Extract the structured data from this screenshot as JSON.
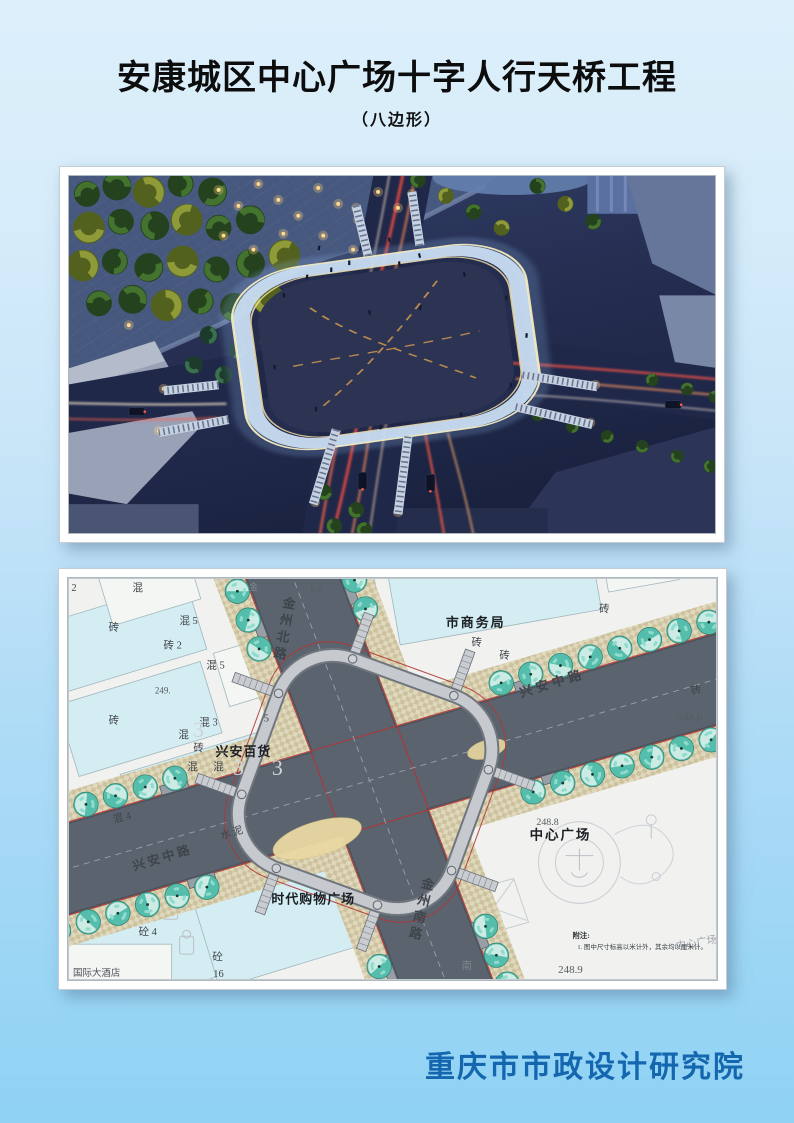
{
  "header": {
    "title": "安康城区中心广场十字人行天桥工程",
    "subtitle": "（八边形）"
  },
  "footer": {
    "organization": "重庆市市政设计研究院"
  },
  "colors": {
    "page_bg_top": "#dceffb",
    "page_bg_bottom": "#8fd2f4",
    "title_text": "#0d0d0d",
    "footer_text": "#1467ae",
    "map_road": "#5a636e",
    "map_sidewalk": "#d5cbaa",
    "map_building": "#d3edf3",
    "map_tree": "#55bdab",
    "map_red_line": "#b23636",
    "render_night_sky": "#222b4c",
    "render_ring_glow": "#cfe4f8"
  },
  "map": {
    "labels": [
      {
        "text": "金州北路",
        "x": 221,
        "y": 30,
        "size": 13,
        "w": 600,
        "vertical": true,
        "dy": 17,
        "rot": 10,
        "name": "label-jinzhou-north-road"
      },
      {
        "text": "金州南路",
        "x": 360,
        "y": 312,
        "size": 13,
        "w": 600,
        "vertical": true,
        "dy": 17,
        "rot": 14,
        "name": "label-jinzhou-south-road"
      },
      {
        "text": "兴安中路",
        "x": 487,
        "y": 110,
        "size": 13,
        "w": 600,
        "rot": -17,
        "ls": 4,
        "name": "label-xingan-middle-road-east"
      },
      {
        "text": "兴安中路",
        "x": 96,
        "y": 285,
        "size": 12.5,
        "w": 600,
        "rot": -17,
        "ls": 3,
        "name": "label-xingan-middle-road-west"
      },
      {
        "text": "市商务局",
        "x": 409,
        "y": 49,
        "size": 13,
        "w": 700,
        "ls": 2,
        "color": "#1b1f24",
        "name": "label-commerce-bureau"
      },
      {
        "text": "兴安百货",
        "x": 176,
        "y": 179,
        "size": 13,
        "w": 700,
        "ls": 1,
        "color": "#1b1f24",
        "name": "label-xingan-department-store"
      },
      {
        "text": "时代购物广场",
        "x": 246,
        "y": 327,
        "size": 13,
        "w": 700,
        "ls": 1,
        "color": "#1b1f24",
        "name": "label-times-shopping-plaza"
      },
      {
        "text": "中心广场",
        "x": 494,
        "y": 263,
        "size": 13.5,
        "w": 700,
        "ls": 2,
        "color": "#1b1f24",
        "name": "label-center-plaza"
      },
      {
        "text": "中心广场",
        "x": 631,
        "y": 370,
        "size": 10.5,
        "color": "#9aa2aa",
        "rot": -10,
        "name": "label-center-plaza-small"
      },
      {
        "text": "国际大酒店",
        "x": 5,
        "y": 400,
        "size": 9.5,
        "color": "#4a4f55",
        "anchor": "start",
        "name": "label-international-hotel"
      },
      {
        "text": "附注:",
        "x": 506,
        "y": 362,
        "size": 7.5,
        "w": 700,
        "anchor": "start",
        "color": "#2e3338",
        "name": "label-note-title"
      },
      {
        "text": "1. 图中尺寸标高以米计外，其余均以厘米计。",
        "x": 511,
        "y": 373,
        "size": 6.5,
        "anchor": "start",
        "color": "#3a4046",
        "name": "label-note-item"
      },
      {
        "text": "248.6",
        "x": 624,
        "y": 143,
        "size": 11,
        "color": "#565b62",
        "name": "label-elevation"
      },
      {
        "text": "248.8",
        "x": 481,
        "y": 248,
        "size": 10,
        "color": "#565b62",
        "name": "label-elevation"
      },
      {
        "text": "248.9",
        "x": 504,
        "y": 397,
        "size": 11,
        "color": "#565b62",
        "name": "label-elevation"
      },
      {
        "text": "249.",
        "x": 95,
        "y": 116,
        "size": 9,
        "color": "#565b62",
        "name": "label-elevation"
      },
      {
        "text": "8.9",
        "x": 249,
        "y": 14,
        "size": 9,
        "color": "#565b62",
        "name": "label-elevation"
      },
      {
        "text": "混",
        "x": 70,
        "y": 13
      },
      {
        "text": "砖",
        "x": 46,
        "y": 53
      },
      {
        "text": "混 5",
        "x": 121,
        "y": 46
      },
      {
        "text": "砖 2",
        "x": 105,
        "y": 71
      },
      {
        "text": "混 5",
        "x": 148,
        "y": 91
      },
      {
        "text": "砖",
        "x": 46,
        "y": 146
      },
      {
        "text": "混 3",
        "x": 141,
        "y": 148
      },
      {
        "text": "5",
        "x": 199,
        "y": 144
      },
      {
        "text": "混",
        "x": 116,
        "y": 161
      },
      {
        "text": "砖",
        "x": 131,
        "y": 174
      },
      {
        "text": "混",
        "x": 125,
        "y": 193
      },
      {
        "text": "混",
        "x": 151,
        "y": 193
      },
      {
        "text": "2",
        "x": 6,
        "y": 13
      },
      {
        "text": "砖",
        "x": 410,
        "y": 68
      },
      {
        "text": "砖",
        "x": 438,
        "y": 81
      },
      {
        "text": "砖",
        "x": 538,
        "y": 34
      },
      {
        "text": "砖",
        "x": 631,
        "y": 116,
        "rot": -15
      },
      {
        "text": "混 4",
        "x": 55,
        "y": 244,
        "rot": -15
      },
      {
        "text": "水泥",
        "x": 166,
        "y": 259,
        "rot": -17,
        "ls": 2
      },
      {
        "text": "砼 4",
        "x": 80,
        "y": 359
      },
      {
        "text": "砼",
        "x": 150,
        "y": 384
      },
      {
        "text": "16",
        "x": 151,
        "y": 401
      },
      {
        "text": "南",
        "x": 400,
        "y": 393,
        "color": "#7f868d"
      },
      {
        "text": "金",
        "x": 186,
        "y": 12,
        "size": 9,
        "color": "#7f868d"
      },
      {
        "text": "3",
        "x": 131,
        "y": 160,
        "size": 22,
        "color": "#ccd3d8",
        "name": "ghost-number"
      },
      {
        "text": "3",
        "x": 171,
        "y": 198,
        "size": 22,
        "color": "#ccd3d8",
        "name": "ghost-number"
      },
      {
        "text": "3",
        "x": 210,
        "y": 198,
        "size": 22,
        "color": "#ccd3d8",
        "name": "ghost-number"
      }
    ]
  }
}
